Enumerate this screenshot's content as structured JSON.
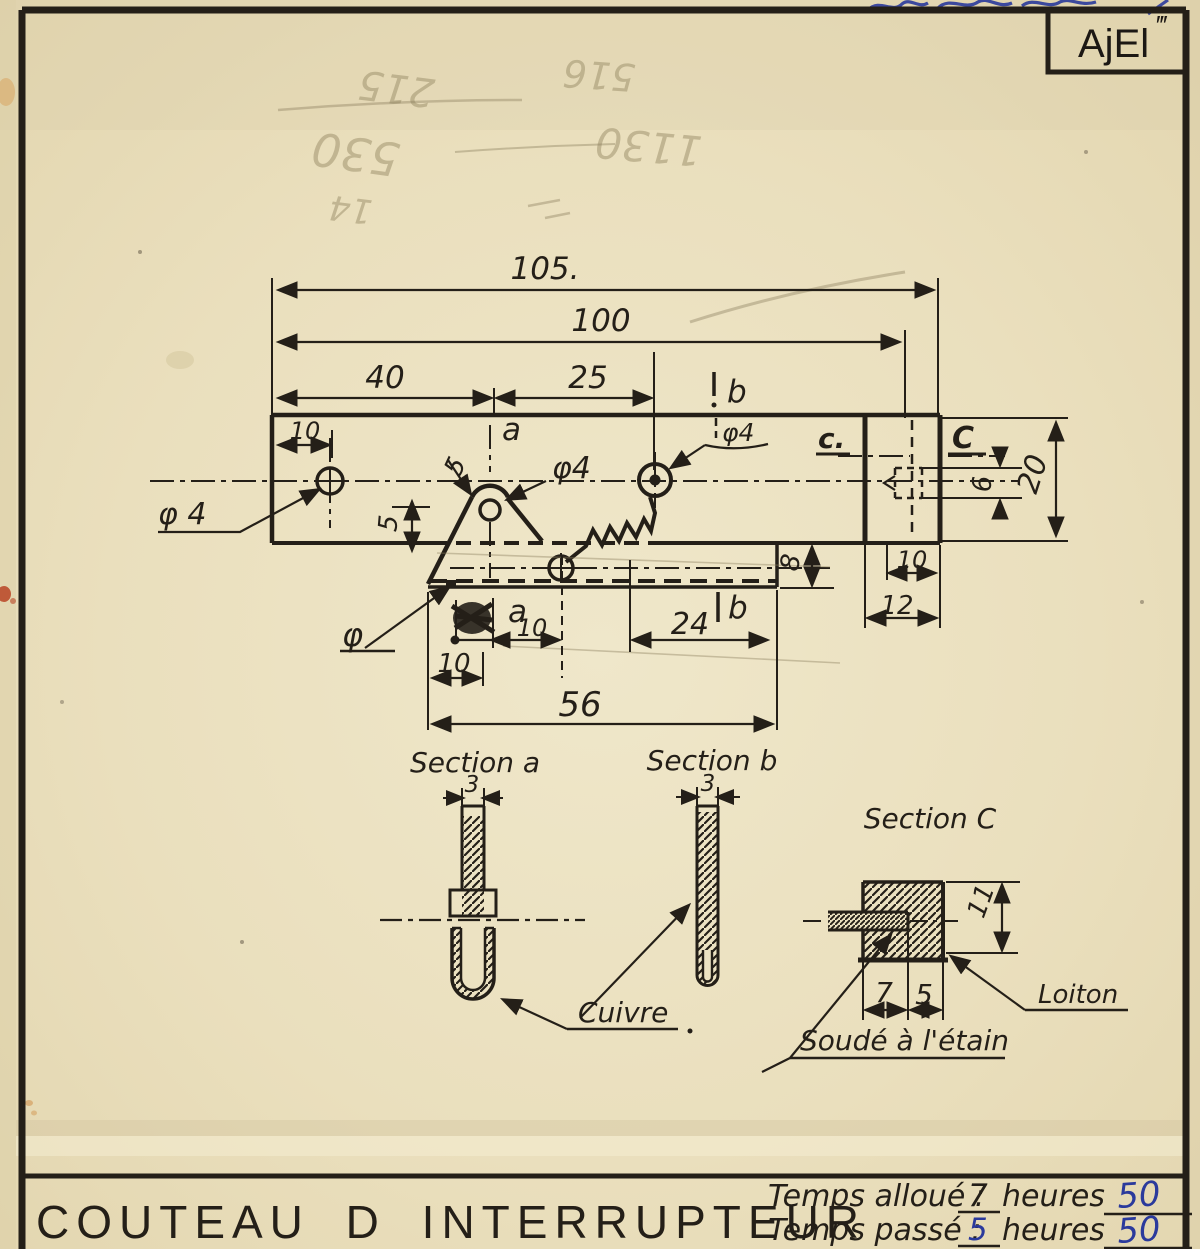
{
  "corner_mark": {
    "code": "AjEl",
    "primes": "‴"
  },
  "ghost_pencil": {
    "g1": "215",
    "g2": "530",
    "g3": "516",
    "g4": "1130",
    "g5": "14"
  },
  "main_view": {
    "dim_105": "105.",
    "dim_100": "100",
    "dim_40": "40",
    "dim_25": "25",
    "dim_10_top": "10",
    "section_a_top": "a",
    "section_b_top": "b",
    "phi4_left": "φ 4",
    "r5": "5",
    "phi4_mid": "φ4",
    "phi4_right": "φ4",
    "c_small": "c.",
    "c_big": "C",
    "dim_6": "6",
    "dim_20": "20",
    "dim_5": "5",
    "dim_8": "8",
    "dim_10_end": "10",
    "dim_12": "12",
    "section_a_bot": "a",
    "dim_10_a": "10",
    "dim_24": "24",
    "section_b_bot": "b",
    "dim_10_left": "10",
    "dim_56": "56",
    "phi_bot": "φ"
  },
  "sections": {
    "a_title": "Section a",
    "a_dim": "3",
    "b_title": "Section b",
    "b_dim": "3",
    "cuivre": "Cuivre",
    "c_title": "Section C",
    "c_dim_11": "11",
    "c_dim_7": "7",
    "c_dim_5": "5",
    "soude": "Soudé à l'étain",
    "laiton": "Loiton"
  },
  "title_block": {
    "title": "COUTEAU D INTERRUPTEUR",
    "allocated_label": "Temps alloué :",
    "allocated_value": "7",
    "allocated_unit": "heures",
    "allocated_mark": "50",
    "spent_label": "Temps passé :",
    "spent_value": "5",
    "spent_unit": "heures",
    "spent_mark": "50"
  },
  "colors": {
    "ink": "#241f18",
    "blue": "#2b3a9c",
    "paper": "#e9ddba",
    "stain_red": "#b84425"
  }
}
